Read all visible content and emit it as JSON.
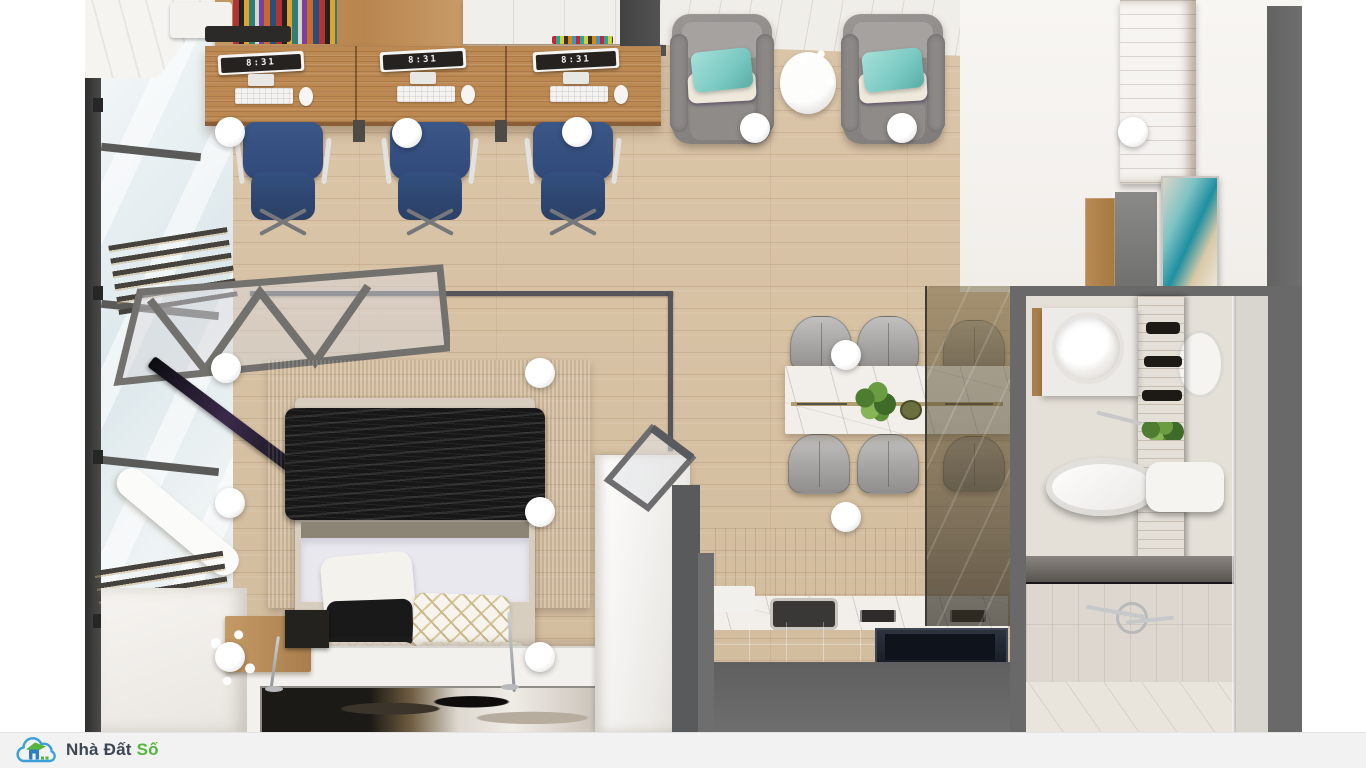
{
  "branding": {
    "company": "Nhà Đất Số",
    "name_primary": "Nhà Đất",
    "name_accent": "Số"
  },
  "workstations": {
    "monitors": [
      {
        "time": "8:31"
      },
      {
        "time": "8:31"
      },
      {
        "time": "8:31"
      }
    ]
  },
  "palette": {
    "floor_wood": "#d8c3a6",
    "desk_wood": "#bd8952",
    "chair_blue": "#3b5787",
    "armchair_gray": "#8f8c8a",
    "pillow_teal": "#79c9c2",
    "deck_white": "#f0eee9",
    "rug_gray": "#969492",
    "blanket_black": "#171717",
    "duvet_white": "#e9e8ef",
    "marble_white": "#f2efea",
    "wall_gray": "#696969",
    "bathroom_tile": "#ddd7cf",
    "bar_bg": "#f1f2f1",
    "monitor_time_color": "#f5f5f5",
    "logo_blue": "#3aa0d8",
    "logo_house": "#2e7fc2",
    "logo_green": "#55b53c",
    "logo_text": "#3d4753"
  }
}
